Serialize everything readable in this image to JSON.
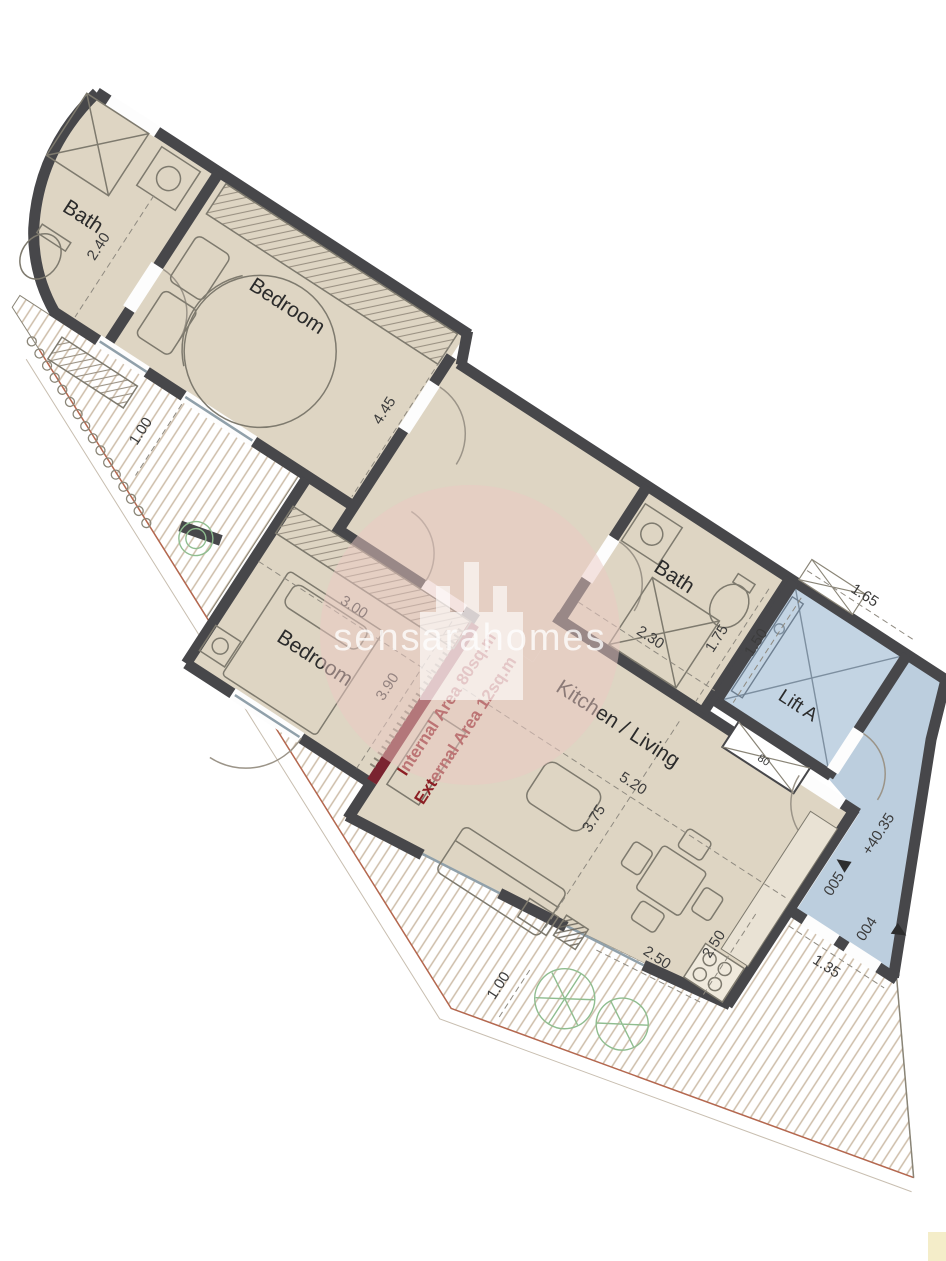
{
  "plan": {
    "watermark_text": "sensarahomes",
    "rooms": {
      "bath1": "Bath",
      "bedroom1": "Bedroom",
      "bedroom2": "Bedroom",
      "bath2": "Bath",
      "kitchen_living": "Kitchen / Living",
      "lift": "Lift A"
    },
    "dimensions": {
      "bath1_width": "2.40",
      "bedroom1_length": "4.45",
      "terrace_width": "1.00",
      "bedroom2_width": "3.00",
      "bedroom2_length": "3.90",
      "bath2_width": "2.30",
      "bath2_depth": "1.75",
      "lift_width": "1.65",
      "lift_depth": "1.50",
      "kitchen_width": "5.20",
      "kitchen_depth": "3.75",
      "kitchen_dim_a": "2.50",
      "kitchen_dim_b": "2.50",
      "balcony_width": "1.00",
      "landing_width": "1.35",
      "shaft": "80"
    },
    "annotations": {
      "internal_area": "Internal Area 80sq.m",
      "external_area": "External Area 12sq.m",
      "floor_level": "+40.35",
      "door_005": "005",
      "door_004": "004"
    },
    "colors": {
      "wall": "#47474a",
      "floor": "#ded5c3",
      "lift_blue": "#c3d4e3",
      "landing_blue": "#bccede",
      "red_wall": "#7a2430",
      "red_text": "#8c1f24",
      "plant_green": "#8fbd8f",
      "watermark_pink": "#ecc9c3"
    }
  }
}
